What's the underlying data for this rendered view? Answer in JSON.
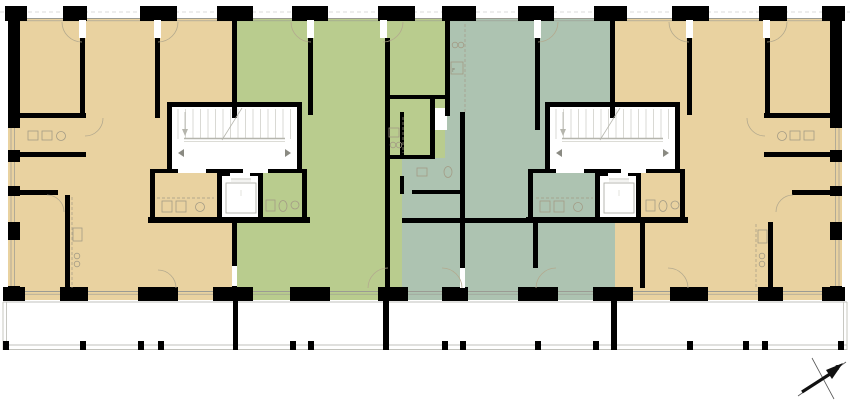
{
  "north": {
    "label": "z"
  },
  "colors": {
    "tan": "#e9d2a0",
    "green": "#b9cc8e",
    "teal": "#adc3b1",
    "wall": "#000000",
    "line": "#9b9b93",
    "dash": "#cfcfcf",
    "balcony": "#c2c2bc",
    "fixture": "#a39b85",
    "arc": "#b3a98e",
    "white": "#ffffff"
  },
  "plan": {
    "zones": [
      {
        "name": "unit-1-zone",
        "c": "tan",
        "x": 8,
        "y": 18,
        "w": 227,
        "h": 282
      },
      {
        "name": "unit-3-zone",
        "c": "teal",
        "x": 402,
        "y": 18,
        "w": 213,
        "h": 282
      },
      {
        "name": "unit-2-zone",
        "c": "green",
        "x": 235,
        "y": 18,
        "w": 167,
        "h": 282
      },
      {
        "name": "unit-2-zone-ext",
        "c": "green",
        "x": 402,
        "y": 18,
        "w": 43,
        "h": 140
      },
      {
        "name": "unit-4-zone",
        "c": "tan",
        "x": 615,
        "y": 18,
        "w": 227,
        "h": 282
      }
    ],
    "whites_under": [
      {
        "name": "stair-core-left",
        "x": 172,
        "y": 107,
        "w": 125,
        "h": 66
      },
      {
        "name": "stair-core-right",
        "x": 550,
        "y": 107,
        "w": 125,
        "h": 66
      },
      {
        "name": "elevator-shaft-left",
        "x": 222,
        "y": 176,
        "w": 38,
        "h": 42
      },
      {
        "name": "elevator-shaft-right",
        "x": 600,
        "y": 176,
        "w": 38,
        "h": 42
      },
      {
        "name": "closet-niche",
        "x": 435,
        "y": 108,
        "w": 12,
        "h": 22
      }
    ],
    "walls": [
      [
        8,
        20,
        12,
        108
      ],
      [
        8,
        150,
        12,
        12
      ],
      [
        8,
        186,
        12,
        10
      ],
      [
        8,
        222,
        12,
        18
      ],
      [
        8,
        286,
        12,
        14
      ],
      [
        830,
        20,
        12,
        108
      ],
      [
        830,
        150,
        12,
        12
      ],
      [
        830,
        186,
        12,
        10
      ],
      [
        830,
        222,
        12,
        18
      ],
      [
        830,
        286,
        12,
        14
      ],
      [
        80,
        38,
        5,
        77
      ],
      [
        155,
        38,
        5,
        80
      ],
      [
        232,
        20,
        5,
        98
      ],
      [
        308,
        38,
        5,
        77
      ],
      [
        385,
        38,
        5,
        252
      ],
      [
        445,
        20,
        5,
        96
      ],
      [
        535,
        38,
        5,
        92
      ],
      [
        610,
        20,
        5,
        98
      ],
      [
        687,
        38,
        5,
        77
      ],
      [
        765,
        38,
        5,
        80
      ],
      [
        8,
        113,
        78,
        5
      ],
      [
        8,
        152,
        78,
        5
      ],
      [
        8,
        190,
        50,
        5
      ],
      [
        764,
        113,
        78,
        5
      ],
      [
        764,
        152,
        78,
        5
      ],
      [
        792,
        190,
        50,
        5
      ],
      [
        167,
        102,
        135,
        5
      ],
      [
        167,
        107,
        5,
        62
      ],
      [
        297,
        107,
        5,
        62
      ],
      [
        150,
        169,
        157,
        4
      ],
      [
        150,
        173,
        5,
        49
      ],
      [
        217,
        176,
        5,
        41
      ],
      [
        258,
        176,
        5,
        41
      ],
      [
        302,
        173,
        5,
        49
      ],
      [
        148,
        217,
        162,
        6
      ],
      [
        217,
        173,
        46,
        3
      ],
      [
        545,
        102,
        135,
        5
      ],
      [
        545,
        107,
        5,
        62
      ],
      [
        675,
        107,
        5,
        62
      ],
      [
        528,
        169,
        157,
        4
      ],
      [
        528,
        173,
        5,
        49
      ],
      [
        595,
        176,
        5,
        41
      ],
      [
        636,
        176,
        5,
        41
      ],
      [
        680,
        173,
        5,
        49
      ],
      [
        526,
        217,
        162,
        6
      ],
      [
        595,
        173,
        46,
        3
      ],
      [
        385,
        95,
        62,
        4
      ],
      [
        400,
        112,
        4,
        46
      ],
      [
        400,
        176,
        4,
        18
      ],
      [
        430,
        95,
        5,
        63
      ],
      [
        385,
        155,
        50,
        4
      ],
      [
        412,
        190,
        52,
        4
      ],
      [
        460,
        112,
        5,
        158
      ],
      [
        402,
        218,
        137,
        5
      ],
      [
        65,
        195,
        5,
        93
      ],
      [
        232,
        222,
        5,
        66
      ],
      [
        533,
        223,
        5,
        45
      ],
      [
        640,
        223,
        5,
        65
      ],
      [
        768,
        222,
        5,
        66
      ]
    ],
    "piers_top": [
      [
        5,
        22
      ],
      [
        63,
        24
      ],
      [
        140,
        37
      ],
      [
        217,
        36
      ],
      [
        292,
        36
      ],
      [
        378,
        37
      ],
      [
        442,
        34
      ],
      [
        518,
        36
      ],
      [
        594,
        33
      ],
      [
        672,
        37
      ],
      [
        759,
        28
      ],
      [
        822,
        23
      ]
    ],
    "piers_bottom": [
      [
        3,
        22
      ],
      [
        60,
        28
      ],
      [
        138,
        40
      ],
      [
        213,
        40
      ],
      [
        290,
        40
      ],
      [
        378,
        30
      ],
      [
        442,
        26
      ],
      [
        518,
        40
      ],
      [
        593,
        40
      ],
      [
        670,
        38
      ],
      [
        758,
        25
      ],
      [
        822,
        23
      ]
    ],
    "whites_over": [
      [
        79,
        20,
        7,
        18
      ],
      [
        154,
        20,
        7,
        18
      ],
      [
        307,
        20,
        7,
        18
      ],
      [
        380,
        20,
        7,
        18
      ],
      [
        534,
        20,
        7,
        18
      ],
      [
        686,
        20,
        7,
        18
      ],
      [
        763,
        20,
        7,
        18
      ],
      [
        178,
        169,
        28,
        4
      ],
      [
        243,
        169,
        25,
        4
      ],
      [
        556,
        169,
        28,
        4
      ],
      [
        621,
        169,
        25,
        4
      ],
      [
        230,
        173,
        20,
        3
      ],
      [
        608,
        173,
        20,
        3
      ],
      [
        460,
        268,
        5,
        20
      ],
      [
        232,
        266,
        5,
        20
      ]
    ],
    "hlines": [
      [
        0,
        12,
        850,
        12,
        0.8,
        "4 3"
      ],
      [
        8,
        18.5,
        842,
        18.5,
        0.9,
        null
      ],
      [
        8,
        20.8,
        842,
        20.8,
        0.6,
        null
      ],
      [
        8,
        291.5,
        842,
        291.5,
        0.9,
        null
      ],
      [
        8,
        294.2,
        842,
        294.2,
        0.6,
        null
      ]
    ],
    "side_windows": {
      "gaps": [
        [
          128,
          150
        ],
        [
          162,
          186
        ],
        [
          196,
          222
        ],
        [
          240,
          286
        ]
      ],
      "left_xs": [
        11,
        14.5
      ],
      "right_xs": [
        835.5,
        839
      ]
    },
    "arcs": [
      [
        82,
        22,
        20,
        180,
        90
      ],
      [
        158,
        22,
        20,
        0,
        90
      ],
      [
        311,
        22,
        20,
        180,
        90
      ],
      [
        383,
        22,
        20,
        0,
        90
      ],
      [
        538,
        22,
        20,
        0,
        90
      ],
      [
        689,
        22,
        20,
        180,
        90
      ],
      [
        767,
        22,
        20,
        0,
        90
      ],
      [
        85,
        118,
        18,
        0,
        90
      ],
      [
        765,
        118,
        18,
        90,
        180
      ],
      [
        47,
        212,
        17,
        270,
        360
      ],
      [
        793,
        212,
        17,
        180,
        270
      ],
      [
        158,
        288,
        18,
        270,
        360
      ],
      [
        388,
        288,
        20,
        180,
        270
      ],
      [
        442,
        288,
        20,
        270,
        360
      ],
      [
        556,
        288,
        20,
        180,
        270
      ],
      [
        668,
        288,
        20,
        270,
        360
      ]
    ],
    "markers": [
      [
        184,
        149,
        "w"
      ],
      [
        285,
        149,
        "e"
      ],
      [
        562,
        149,
        "w"
      ],
      [
        663,
        149,
        "e"
      ]
    ],
    "stairs": {
      "cores": [
        {
          "x": 172,
          "y": 107
        },
        {
          "x": 550,
          "y": 107
        }
      ],
      "treads": 16,
      "step": 7.5
    },
    "elevators": [
      {
        "x": 222,
        "y": 176
      },
      {
        "x": 600,
        "y": 176
      }
    ],
    "fixtures": [
      {
        "t": "r",
        "x": 28,
        "y": 131,
        "w": 10,
        "h": 9
      },
      {
        "t": "r",
        "x": 42,
        "y": 131,
        "w": 10,
        "h": 9
      },
      {
        "t": "c",
        "x": 61,
        "y": 136,
        "r": 4.5
      },
      {
        "t": "r",
        "x": 790,
        "y": 131,
        "w": 10,
        "h": 9
      },
      {
        "t": "r",
        "x": 804,
        "y": 131,
        "w": 10,
        "h": 9
      },
      {
        "t": "c",
        "x": 782,
        "y": 136,
        "r": 4.5
      },
      {
        "t": "l",
        "x": 157,
        "y": 198,
        "x2": 214,
        "y2": 198
      },
      {
        "t": "r",
        "x": 162,
        "y": 201,
        "w": 10,
        "h": 11
      },
      {
        "t": "r",
        "x": 176,
        "y": 201,
        "w": 10,
        "h": 11
      },
      {
        "t": "c",
        "x": 200,
        "y": 207,
        "r": 4.5
      },
      {
        "t": "r",
        "x": 266,
        "y": 200,
        "w": 9,
        "h": 11
      },
      {
        "t": "e",
        "x": 283,
        "y": 206,
        "rx": 4,
        "ry": 5.5
      },
      {
        "t": "c",
        "x": 295,
        "y": 205,
        "r": 4
      },
      {
        "t": "l",
        "x": 536,
        "y": 198,
        "x2": 593,
        "y2": 198
      },
      {
        "t": "r",
        "x": 540,
        "y": 201,
        "w": 10,
        "h": 11
      },
      {
        "t": "r",
        "x": 554,
        "y": 201,
        "w": 10,
        "h": 11
      },
      {
        "t": "c",
        "x": 578,
        "y": 207,
        "r": 4.5
      },
      {
        "t": "r",
        "x": 646,
        "y": 200,
        "w": 9,
        "h": 11
      },
      {
        "t": "e",
        "x": 663,
        "y": 206,
        "rx": 4,
        "ry": 5.5
      },
      {
        "t": "c",
        "x": 675,
        "y": 205,
        "r": 4
      },
      {
        "t": "l",
        "x": 403,
        "y": 117,
        "x2": 403,
        "y2": 153
      },
      {
        "t": "r",
        "x": 389,
        "y": 128,
        "w": 10,
        "h": 9
      },
      {
        "t": "c",
        "x": 393,
        "y": 145,
        "r": 2.8
      },
      {
        "t": "c",
        "x": 399,
        "y": 145,
        "r": 2.8
      },
      {
        "t": "r",
        "x": 417,
        "y": 168,
        "w": 10,
        "h": 8
      },
      {
        "t": "e",
        "x": 448,
        "y": 172,
        "rx": 4,
        "ry": 5.5
      },
      {
        "t": "l",
        "x": 465,
        "y": 24,
        "x2": 465,
        "y2": 112
      },
      {
        "t": "c",
        "x": 455,
        "y": 45,
        "r": 2.8
      },
      {
        "t": "c",
        "x": 461,
        "y": 45,
        "r": 2.8
      },
      {
        "t": "r",
        "x": 451,
        "y": 62,
        "w": 12,
        "h": 12
      },
      {
        "t": "x",
        "x": 452,
        "y": 72,
        "s": "F"
      },
      {
        "t": "l",
        "x": 72,
        "y": 197,
        "x2": 72,
        "y2": 288
      },
      {
        "t": "r",
        "x": 73,
        "y": 228,
        "w": 9,
        "h": 13
      },
      {
        "t": "c",
        "x": 77,
        "y": 256,
        "r": 2.8
      },
      {
        "t": "c",
        "x": 77,
        "y": 264,
        "r": 2.8
      },
      {
        "t": "l",
        "x": 756,
        "y": 224,
        "x2": 756,
        "y2": 288
      },
      {
        "t": "r",
        "x": 758,
        "y": 230,
        "w": 9,
        "h": 13
      },
      {
        "t": "c",
        "x": 762,
        "y": 256,
        "r": 2.8
      },
      {
        "t": "c",
        "x": 762,
        "y": 264,
        "r": 2.8
      }
    ],
    "balcony": {
      "hlines": [
        [
          3,
          302,
          847,
          302
        ],
        [
          3,
          345,
          847,
          345
        ],
        [
          3,
          349.5,
          847,
          349.5
        ]
      ],
      "vlines": [
        [
          3,
          302,
          3,
          350
        ],
        [
          6.5,
          302,
          6.5,
          350
        ],
        [
          843.5,
          302,
          843.5,
          350
        ],
        [
          847,
          302,
          847,
          350
        ]
      ],
      "posts_x": [
        3,
        80,
        138,
        158,
        290,
        308,
        442,
        460,
        535,
        593,
        687,
        743,
        762,
        838
      ],
      "post_y": 341,
      "post_w": 6,
      "post_h": 9,
      "stubs": [
        [
          233,
          300,
          5,
          50
        ],
        [
          383,
          300,
          6,
          50
        ],
        [
          611,
          300,
          6,
          50
        ]
      ]
    },
    "north_arrow": {
      "thin_lines": [
        [
          798,
          396,
          846,
          362
        ],
        [
          812,
          358,
          834,
          399
        ]
      ],
      "shaft": [
        802,
        392,
        830,
        374
      ],
      "head": [
        [
          826,
          370
        ],
        [
          843,
          363
        ],
        [
          832,
          379
        ]
      ],
      "label_pos": [
        837,
        370
      ]
    }
  }
}
